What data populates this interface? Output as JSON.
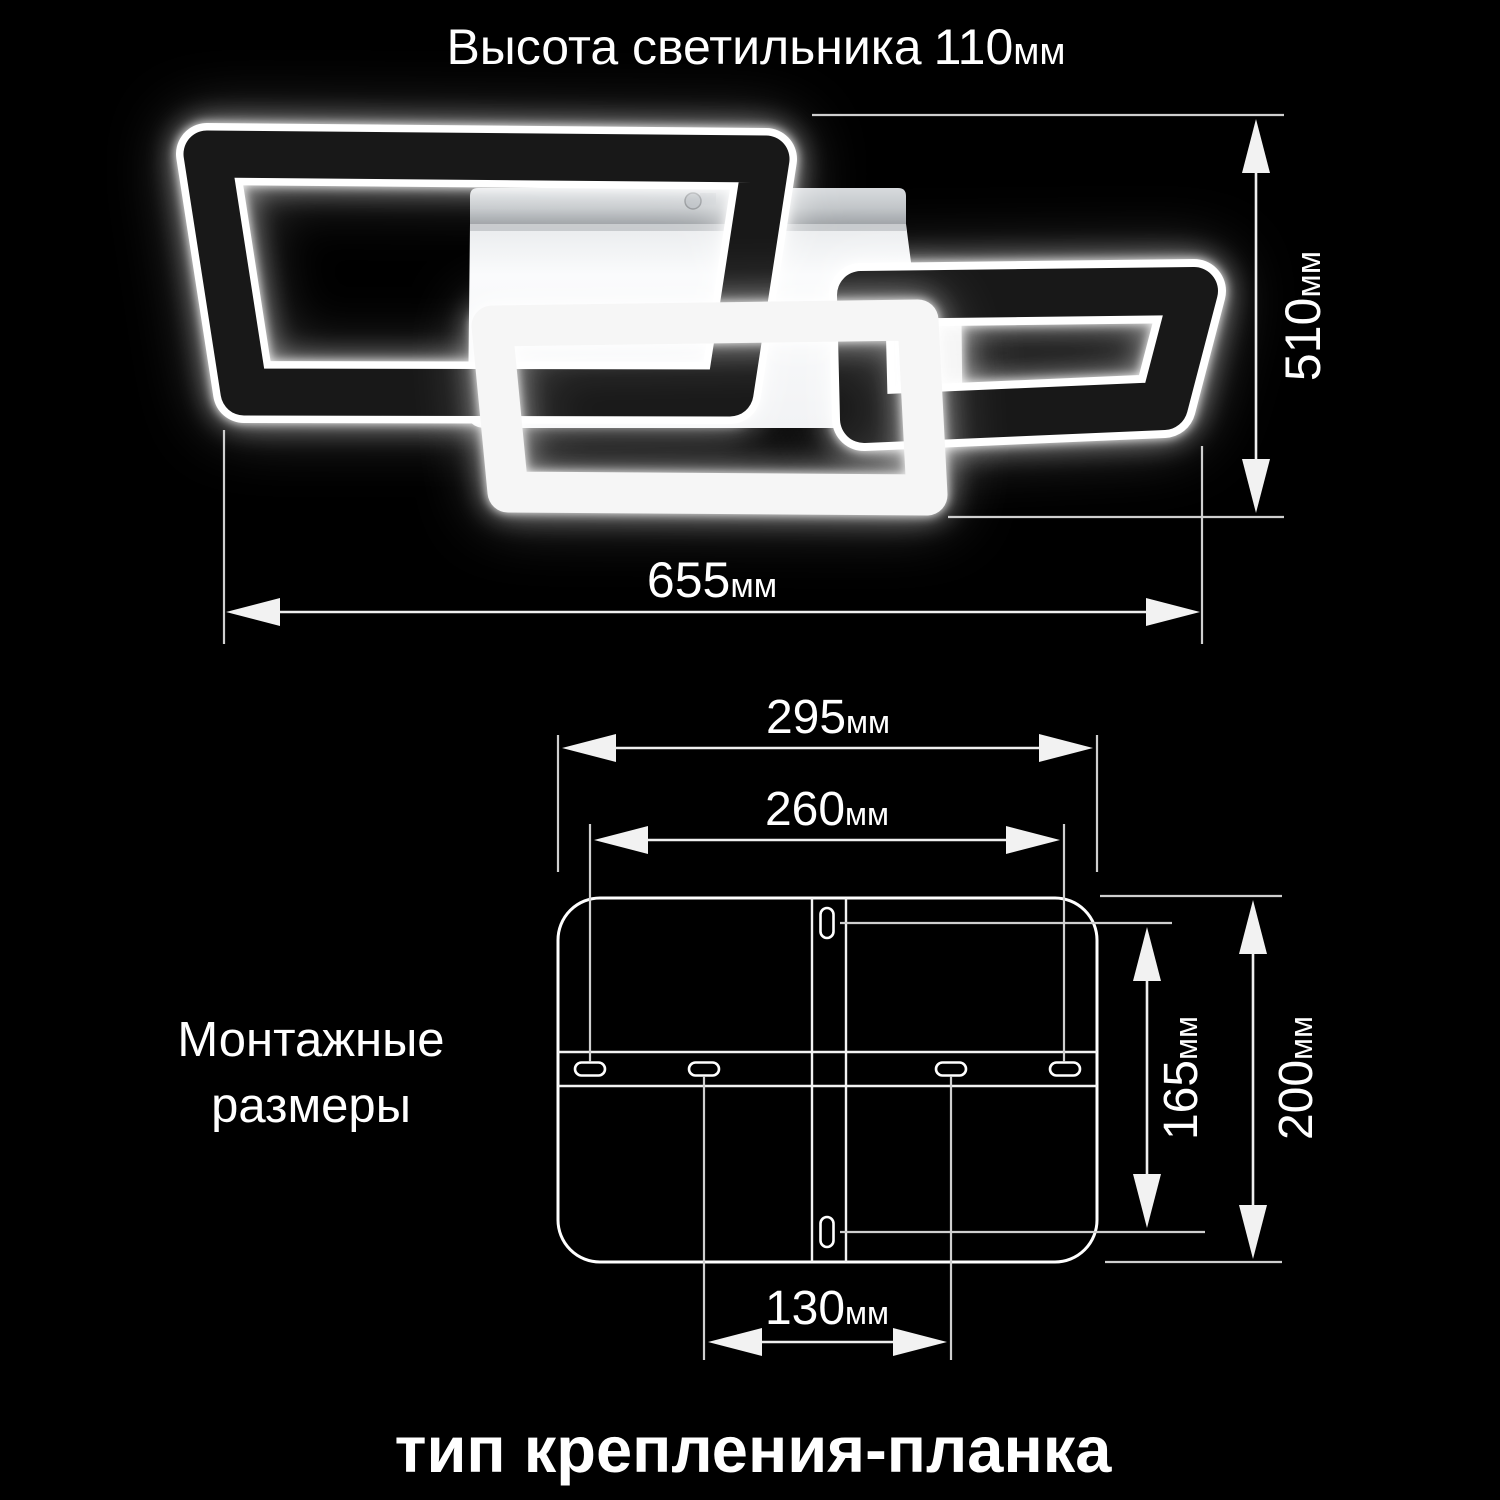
{
  "colors": {
    "background": "#000000",
    "text": "#ffffff",
    "dimension_line": "#efefef",
    "reference_line": "#cfcfcf",
    "frame_dark": "#181818",
    "frame_white": "#f6f6f6",
    "canopy_top": "#c8cbce",
    "canopy_body": "#f6f6f8"
  },
  "top_title": {
    "label": "Высота светильника",
    "value": "110",
    "unit": "мм"
  },
  "side_label": {
    "line1": "Монтажные",
    "line2": "размеры"
  },
  "bottom_title": "тип крепления-планка",
  "dimensions": {
    "lamp_width": {
      "value": "655",
      "unit": "мм"
    },
    "lamp_height": {
      "value": "510",
      "unit": "мм"
    },
    "plate_width": {
      "value": "295",
      "unit": "мм"
    },
    "mount_holes_width": {
      "value": "260",
      "unit": "мм"
    },
    "mount_holes_height": {
      "value": "165",
      "unit": "мм"
    },
    "plate_height": {
      "value": "200",
      "unit": "мм"
    },
    "center_holes_spacing": {
      "value": "130",
      "unit": "мм"
    }
  }
}
